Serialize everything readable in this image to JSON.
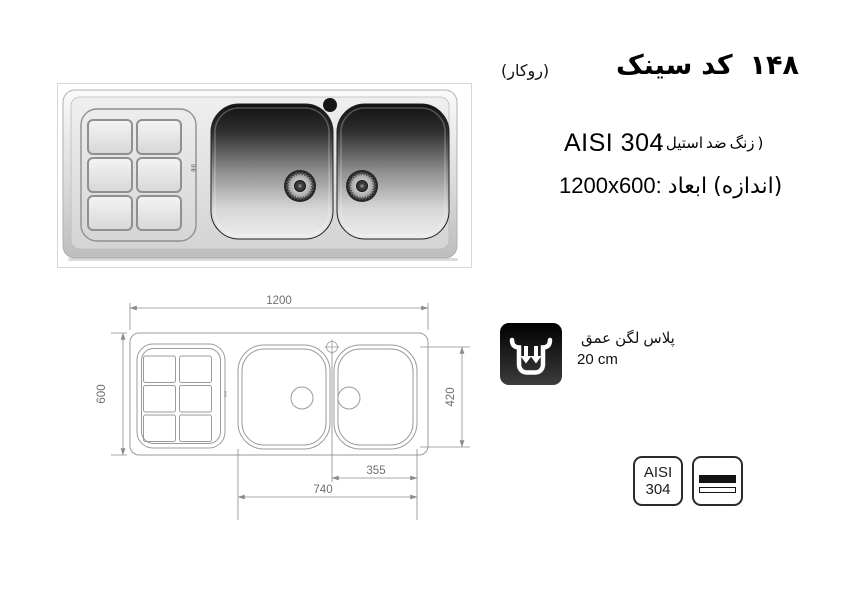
{
  "header": {
    "mount_type": "(روکار)",
    "title_words": [
      "سینک",
      "کد",
      "۱۴۸"
    ],
    "steel_grade": "AISI 304",
    "steel_note_words": [
      "(",
      "استیل",
      "ضد",
      "زنگ",
      ")"
    ],
    "size_value": "1200x600:",
    "size_label_word1": "ابعاد",
    "size_label_word2": "(اندازه)"
  },
  "depth_feature": {
    "label_words": [
      "عمق",
      "لگن",
      "پلاس"
    ],
    "value": "20 cm",
    "icon": "bowl-depth-arrows-icon"
  },
  "drawing": {
    "dim_overall_width": "1200",
    "dim_overall_depth": "600",
    "dim_bowl_depth": "420",
    "dim_single_bowl_width": "355",
    "dim_double_bowl_width": "740",
    "brand_mark": "IHI"
  },
  "photo": {
    "brand_mark": "IHI"
  },
  "badges": {
    "grade_line1": "AISI",
    "grade_line2": "304",
    "sheet_icon": "steel-sheet-icon"
  },
  "colors": {
    "text": "#000000",
    "drawing_line": "#9b9b9b",
    "dim_text": "#707070",
    "icon_bg": "#0a0a0a",
    "badge_border": "#2b2b2b"
  }
}
